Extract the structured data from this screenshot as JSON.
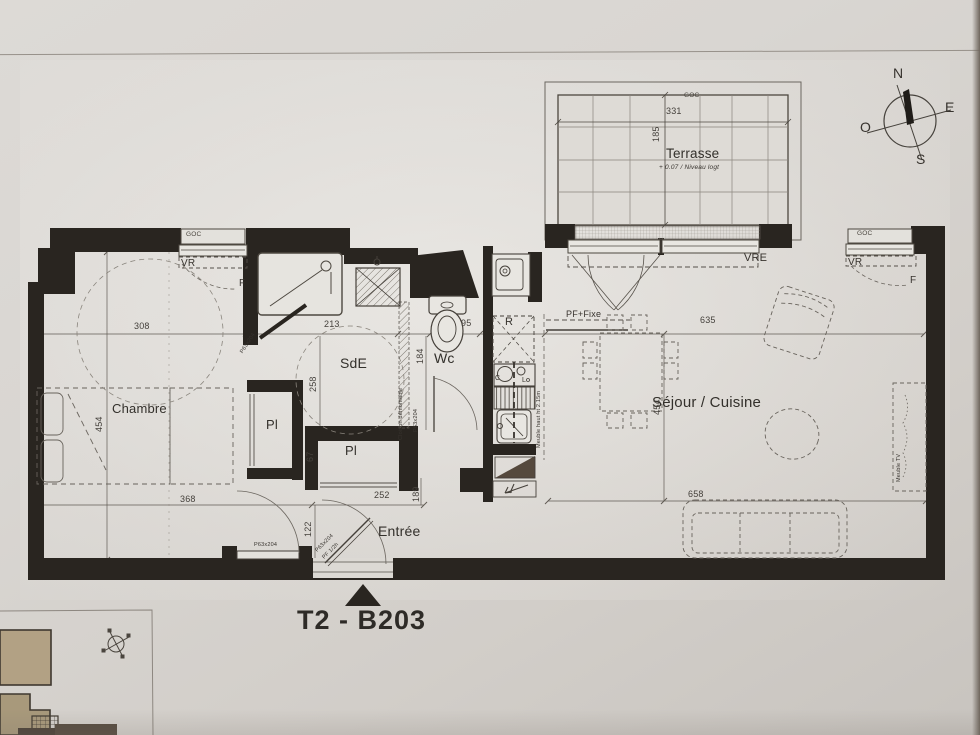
{
  "title": {
    "unit": "T2 - B203"
  },
  "compass": {
    "north": "N",
    "east": "E",
    "south": "S",
    "west": "O"
  },
  "terrace": {
    "name": "Terrasse",
    "level": "+ 0.07 / Niveau logt",
    "shutter_box": "GOC",
    "width": "331",
    "depth": "185"
  },
  "rooms": {
    "bedroom": "Chambre",
    "shower_room": "SdE",
    "wc": "Wc",
    "living_kitchen": "Séjour / Cuisine",
    "entry": "Entrée",
    "closet_1": "Pl",
    "closet_2": "Pl"
  },
  "openings": {
    "shutter_box_left": "GOC",
    "roller_shutter_left": "VR",
    "window_left": "F",
    "bay_shutter": "VRE",
    "shutter_box_right": "GOC",
    "roller_shutter_right": "VR",
    "window_right": "F",
    "fixed_glazing": "PF+Fixe",
    "door_shower": "P63x204",
    "door_wc": "P63x204",
    "door_bedroom": "P63x204",
    "door_entry": "P63x204",
    "door_entry_rating": "PF 1/2h",
    "partition": "Cloison démontable"
  },
  "kitchen": {
    "fridge": "R",
    "hob": "C",
    "appliance": "L",
    "tall_unit": "Meuble haut ht 2.15m",
    "tv_unit": "Meuble TV"
  },
  "dimensions": {
    "bedroom_width": "308",
    "shower_width": "213",
    "wc_width": "95",
    "living_width": "635",
    "bedroom_depth": "454",
    "living_depth": "454",
    "bedroom_south": "368",
    "entry_width": "252",
    "entry_depth": "189",
    "hall": "122",
    "closet": "67",
    "shower_depth": "258",
    "wc_depth": "184",
    "living_south": "658"
  }
}
